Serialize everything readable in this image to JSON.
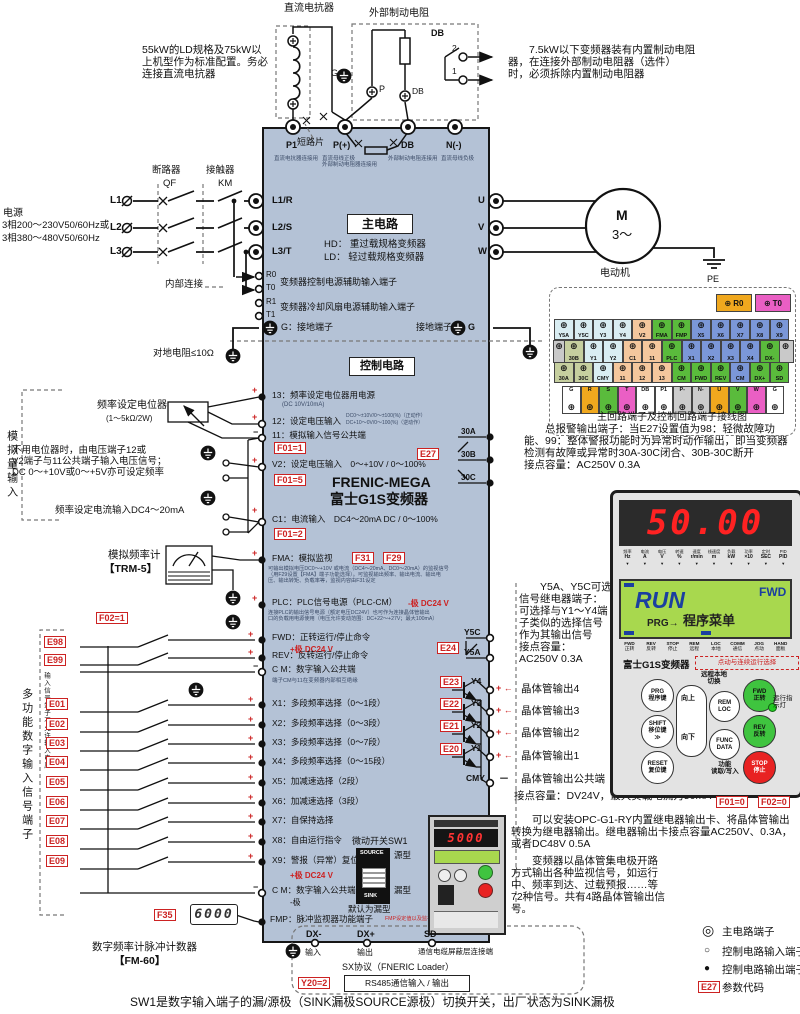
{
  "top": {
    "dc_reactor_label": "直流电抗器",
    "ext_brake_label": "外部制动电阻",
    "dc_note": "55kW的LD规格及75kW以\n上机型作为标准配置。务必\n连接直流电抗器",
    "brake_note": "　　7.5kW以下变频器装有内置制动电阻\n器，在连接外部制动电阻器（选件）\n时，必须拆除内置制动电阻器",
    "db_box": "DB",
    "contact2": "2",
    "contact1": "1",
    "g": "G",
    "p": "P",
    "db_term": "DB"
  },
  "power": {
    "title": "电源",
    "spec1": "3相200～230V50/60Hz或",
    "spec2": "3相380～480V50/60Hz",
    "l1": "L1",
    "l2": "L2",
    "l3": "L3",
    "qf_name": "断路器",
    "qf": "QF",
    "km_name": "接触器",
    "km": "KM",
    "internal": "内部连接",
    "ground_res": "对地电阻≤10Ω"
  },
  "inverter": {
    "main_title": "主电路",
    "hd": "HD： 重过载规格变频器",
    "ld": "LD： 轻过载规格变频器",
    "ctrl_title": "控制电路",
    "brand1": "FRENIC-MEGA",
    "brand2": "富士G1S变频器",
    "aux1": "变频器控制电源辅助输入端子",
    "aux2": "变频器冷却风扇电源辅助输入端子",
    "g_left": "G：接地端子",
    "g_right": "接地端子",
    "g_right2": "G",
    "p1": "P1",
    "p1_sub": "直流电抗器连接用",
    "pplus": "P(+)",
    "pplus_sub": "直流母线正极\n外部制动电阻器连接用",
    "db": "DB",
    "db_sub": "外部制动电阻连接用",
    "nminus": "N(-)",
    "nminus_sub": "直流母线负极",
    "short_bar": "短路片",
    "l1r": "L1/R",
    "l2s": "L2/S",
    "l3t": "L3/T",
    "r0": "R0",
    "t0": "T0",
    "r1": "R1",
    "t1": "T1",
    "u": "U",
    "v": "V",
    "w": "W"
  },
  "motor": {
    "m": "M",
    "ph": "3～",
    "label": "电动机",
    "pe": "PE"
  },
  "analog": {
    "section": "模拟量输入",
    "pot": "频率设定电位器",
    "pot_sub": "(1～5kΩ/2W)",
    "no_pot": "不用电位器时，由电压端子12或\nV2端子与11公共端子输入电压信号；\nDC 0～+10V或0～+5V亦可设定频率",
    "current": "频率设定电流输入DC4～20mA",
    "meter": "模拟频率计",
    "meter_sub": "【TRM-5】",
    "t13": "13：频率设定电位器用电源",
    "t13_sub": "(DC 10V/10mA)",
    "t12": "12：设定电压输入",
    "t12_sub1": "DC0～±10V/0～±100(%)（正动作）",
    "t12_sub2": "DC+10～0V/0～100(%)（逆动作）",
    "t11": "11：模拟输入信号公共端",
    "f01_1": "F01=1",
    "v2": "V2：设定电压输入　0～+10V / 0～100%",
    "f01_5": "F01=5",
    "c1": "C1：电流输入　DC4～20mA DC / 0～100%",
    "f01_2": "F01=2"
  },
  "fma": {
    "label": "FMA：模拟监视",
    "f31": "F31",
    "f29": "F29",
    "sub": "可输出模拟电压DC0～+10V 或电流（DC4～20mA、DC0～20mA）的监视信号\n（用F29设置【FMA】端子功能选择）。可监视输出频率、输出电流、输出电\n压、输出转矩、负载率等，监视内容由F31设定"
  },
  "plc": {
    "label": "PLC：PLC信号电源（PLC-CM）",
    "red": "-极  DC24 V",
    "sub": "连接PLC的输出信号电源（额定电压DC24V）也可作为连接晶体管输出\n口的负载用电源使用（电压允许变动范围：DC+22～+27V；最大100mA）"
  },
  "run": {
    "e98": "E98",
    "e99": "E99",
    "fwd": "FWD：正转运行/停止命令",
    "fwd_red": "+极  DC24 V",
    "rev": "REV：反转运行/停止命令",
    "cm": "C M：数字输入公共端",
    "cm_sub": "端子CM与11在变频器内部相互绝缘"
  },
  "digital": {
    "f02_1": "F02=1",
    "section": "多功能数字输入信号端子",
    "warn": "输入信号端子不允许输入电压",
    "items": [
      {
        "code": "E01",
        "label": "X1：多段频率选择（0～1段）"
      },
      {
        "code": "E02",
        "label": "X2：多段频率选择（0～3段）"
      },
      {
        "code": "E03",
        "label": "X3：多段频率选择（0～7段）"
      },
      {
        "code": "E04",
        "label": "X4：多段频率选择（0～15段）"
      },
      {
        "code": "E05",
        "label": "X5：加减速选择（2段）"
      },
      {
        "code": "E06",
        "label": "X6：加减速选择（3段）"
      },
      {
        "code": "E07",
        "label": "X7：自保持选择"
      },
      {
        "code": "E08",
        "label": "X8：自由运行指令"
      },
      {
        "code": "E09",
        "label": "X9：警报（异常）复位"
      }
    ],
    "x9_red": "+极  DC24 V",
    "cm2": "C M：数字输入公共端",
    "cm2_sub": "-极",
    "f35": "F35",
    "f35_val": "6000",
    "fmp": "FMP：脉冲监视器功能端子",
    "fmp_red": "FMP设定值以及监视内容与FMA/F31（模拟）相同",
    "counter": "数字频率计脉冲计数器",
    "counter_sub": "【FM-60】"
  },
  "sw1": {
    "title": "微动开关SW1",
    "source": "SOURCE",
    "sink": "SINK",
    "source_type": "源型",
    "sink_type": "漏型",
    "def": "默认为漏型"
  },
  "comm": {
    "dxm": "DX-",
    "dxp": "DX+",
    "sd": "SD",
    "in": "输入",
    "out": "输出",
    "shield": "通信电缆屏蔽层连接端",
    "proto": "SX协议（FNERIC Loader）",
    "y20": "Y20=2",
    "rs485": "RS485通信输入 / 输出"
  },
  "alarm": {
    "e27": "E27",
    "a": "30A",
    "b": "30B",
    "c": "30C",
    "note": "　　总报警输出端子：当E27设置值为98：轻微故障功\n能、99：整体警报功能时为异常时动作输出，即当变频器\n检测有故障或异常时30A-30C闭合、30B-30C断开\n接点容量：AC250V 0.3A"
  },
  "relay": {
    "y5c": "Y5C",
    "y5a": "Y5A",
    "e24": "E24",
    "note": "　　Y5A、Y5C可选\n信号继电器端子：\n可选择与Y1～Y4端\n子类似的选择信号\n作为其输出信号\n接点容量：\nAC250V 0.3A"
  },
  "trans": {
    "rows": [
      {
        "code": "E23",
        "term": "Y4",
        "label": "晶体管输出4"
      },
      {
        "code": "E22",
        "term": "Y3",
        "label": "晶体管输出3"
      },
      {
        "code": "E21",
        "term": "Y2",
        "label": "晶体管输出2"
      },
      {
        "code": "E20",
        "term": "Y1",
        "label": "晶体管输出1"
      }
    ],
    "plus": "+ ←",
    "minus": "－",
    "cmy": "CMY",
    "cmy_label": "晶体管输出公共端",
    "capacity": "接点容量：DV24V，最大负载电流为50mA",
    "opc_note": "　　可以安装OPC-G1-RY内置继电器输出卡、将晶体管输出\n转换为继电器输出。继电器输出卡接点容量AC250V、0.3A，\n或者DC48V 0.5A",
    "oc_note": "　　变频器以晶体管集电极开路\n方式输出各种监视信号，如运行\n中、频率到达、过载预报……等\n72种信号。共有4路晶体管输出信\n号。"
  },
  "tstrip": {
    "r0": "R0",
    "t0": "T0",
    "row1": [
      {
        "l": "Y5A",
        "c": "ltblue"
      },
      {
        "l": "Y5C",
        "c": "ltblue"
      },
      {
        "l": "Y3",
        "c": "ltblue"
      },
      {
        "l": "Y4",
        "c": "ltblue"
      },
      {
        "l": "V2",
        "c": "orange"
      },
      {
        "l": "FMA",
        "c": "green"
      },
      {
        "l": "FMP",
        "c": "green"
      },
      {
        "l": "X5",
        "c": "blue"
      },
      {
        "l": "X6",
        "c": "blue"
      },
      {
        "l": "X7",
        "c": "blue"
      },
      {
        "l": "X8",
        "c": "blue"
      },
      {
        "l": "X9",
        "c": "blue"
      }
    ],
    "row2": [
      {
        "l": "30B",
        "c": "olive"
      },
      {
        "l": "Y1",
        "c": "ltblue"
      },
      {
        "l": "Y2",
        "c": "ltblue"
      },
      {
        "l": "C1",
        "c": "orange"
      },
      {
        "l": "11",
        "c": "orange"
      },
      {
        "l": "PLC",
        "c": "green"
      },
      {
        "l": "X1",
        "c": "blue"
      },
      {
        "l": "X2",
        "c": "blue"
      },
      {
        "l": "X3",
        "c": "blue"
      },
      {
        "l": "X4",
        "c": "blue"
      },
      {
        "l": "DX-",
        "c": "green"
      }
    ],
    "row3": [
      {
        "l": "30A",
        "c": "olive"
      },
      {
        "l": "30C",
        "c": "olive"
      },
      {
        "l": "CMY",
        "c": "ltblue"
      },
      {
        "l": "11",
        "c": "orange"
      },
      {
        "l": "12",
        "c": "orange"
      },
      {
        "l": "13",
        "c": "orange"
      },
      {
        "l": "CM",
        "c": "green"
      },
      {
        "l": "FWD",
        "c": "green"
      },
      {
        "l": "REV",
        "c": "green"
      },
      {
        "l": "CM",
        "c": "blue"
      },
      {
        "l": "DX+",
        "c": "green"
      },
      {
        "l": "SD",
        "c": "green"
      }
    ],
    "bottom": [
      {
        "l": "G",
        "c": "white"
      },
      {
        "l": "R",
        "c": "amber"
      },
      {
        "l": "S",
        "c": "green"
      },
      {
        "l": "T",
        "c": "pink"
      },
      {
        "l": "DB",
        "c": "white"
      },
      {
        "l": "P1",
        "c": "white"
      },
      {
        "l": "P-",
        "c": "gray"
      },
      {
        "l": "N-",
        "c": "gray"
      },
      {
        "l": "U",
        "c": "amber"
      },
      {
        "l": "V",
        "c": "green"
      },
      {
        "l": "W",
        "c": "pink"
      },
      {
        "l": "G",
        "c": "white"
      }
    ],
    "caption": "主回路端子及控制回路端子接线图",
    "screw_icon": "⊕"
  },
  "keypad": {
    "display": "50.00",
    "unit_names": [
      "频率",
      "电流",
      "电压",
      "转速",
      "速度",
      "线速度",
      "负载",
      "功率",
      "定时",
      "PID"
    ],
    "units": [
      "Hz",
      "A",
      "V",
      "%",
      "r/min",
      "m",
      "kW",
      "×10",
      "SEC",
      "PID"
    ],
    "run": "RUN",
    "fwd": "FWD",
    "prg": "PRG→",
    "menu": "程序菜单",
    "status": [
      {
        "en": "FWD",
        "cn": "正转"
      },
      {
        "en": "REV",
        "cn": "反转"
      },
      {
        "en": "STOP",
        "cn": "停止"
      },
      {
        "en": "REM",
        "cn": "远程"
      },
      {
        "en": "LOC",
        "cn": "本地"
      },
      {
        "en": "COMM",
        "cn": "通信"
      },
      {
        "en": "JOG",
        "cn": "点动"
      },
      {
        "en": "HAND",
        "cn": "面板"
      }
    ],
    "brand": "富士G1S变频器",
    "jog_note": "点动与连续运行选择",
    "btn_prg": "PRG\n程序键",
    "btn_shift": "SHIFT\n移位键\n≫",
    "btn_reset": "RESET\n复位键",
    "up": "向上",
    "down": "向下",
    "remloc": "REM\nLOC",
    "remloc_label": "远程本地\n切换",
    "funcdata": "FUNC\nDATA",
    "func_label": "功能\n读取/写入",
    "fwd_btn": "FWD\n正转",
    "rev_btn": "REV\n反转",
    "stop_btn": "STOP\n停止",
    "led_label": "运行指\n示灯",
    "f01": "F01=0",
    "f02": "F02=0",
    "mini_display": "5000"
  },
  "legend": {
    "items": [
      {
        "icon": "◎",
        "label": "主电路端子"
      },
      {
        "icon": "○",
        "label": "控制电路输入端子"
      },
      {
        "icon": "●",
        "label": "控制电路输出端子"
      },
      {
        "icon": "E27",
        "label": "参数代码"
      }
    ]
  },
  "footer": "SW1是数字输入端子的漏/源极（SINK漏极SOURCE源极）切换开关，出厂状态为SINK漏极"
}
